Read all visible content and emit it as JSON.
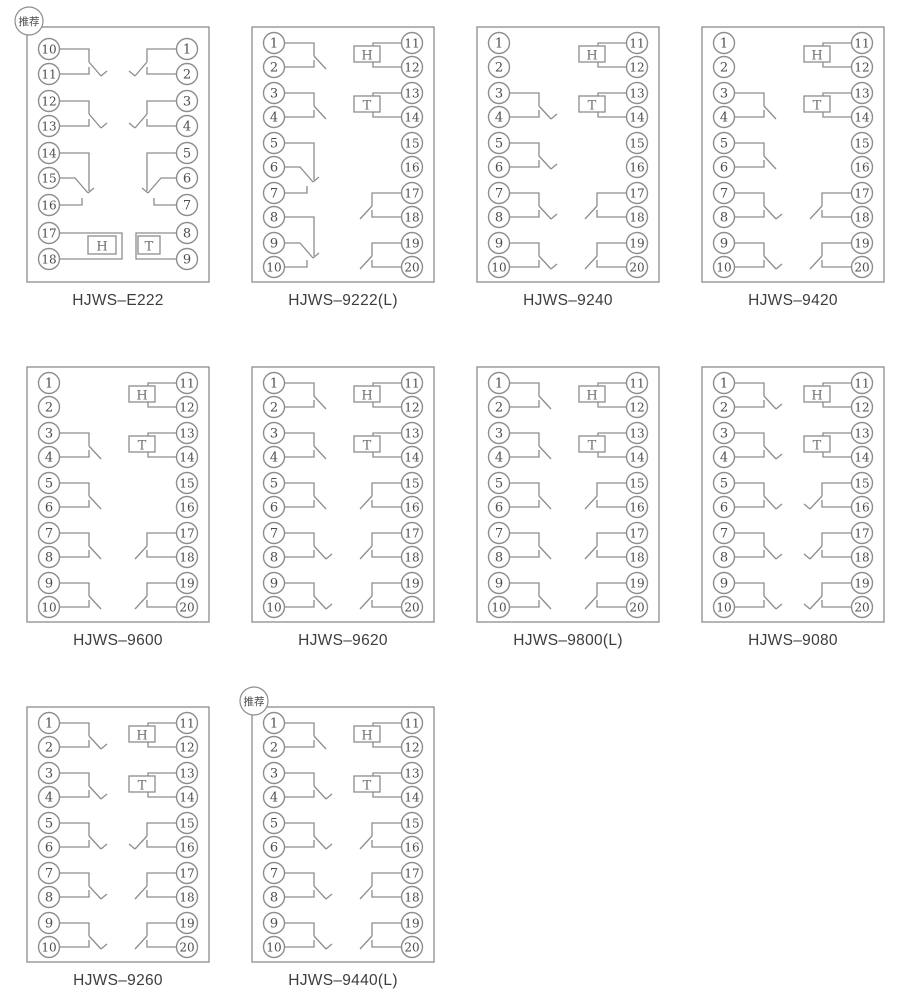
{
  "badge_label": "推荐",
  "colors": {
    "line": "#8d8d8d",
    "terminal_text": "#4c4c4c",
    "label_text": "#3d3d3d",
    "coil_text": "#6e6e6e",
    "background": "#ffffff"
  },
  "diagrams": [
    {
      "id": "hjws-e222",
      "label": "HJWS–E222",
      "badge": true,
      "layout": "nine",
      "left_terminals": [
        "10",
        "11",
        "12",
        "13",
        "14",
        "15",
        "16",
        "17",
        "18"
      ],
      "right_terminals": [
        "1",
        "2",
        "3",
        "4",
        "5",
        "6",
        "7",
        "8",
        "9"
      ],
      "elements": [
        {
          "type": "contact",
          "side": "left",
          "rows": [
            0,
            1
          ],
          "closed": true
        },
        {
          "type": "contact",
          "side": "left",
          "rows": [
            2,
            3
          ],
          "closed": true
        },
        {
          "type": "changeover",
          "side": "left",
          "rows": [
            4,
            5,
            6
          ]
        },
        {
          "type": "coil",
          "side": "left",
          "rows": [
            7,
            8
          ],
          "letter": "H"
        },
        {
          "type": "contact",
          "side": "right",
          "rows": [
            0,
            1
          ],
          "closed": true
        },
        {
          "type": "contact",
          "side": "right",
          "rows": [
            2,
            3
          ],
          "closed": true
        },
        {
          "type": "changeover",
          "side": "right",
          "rows": [
            4,
            5,
            6
          ]
        },
        {
          "type": "coil",
          "side": "right",
          "rows": [
            7,
            8
          ],
          "letter": "T"
        }
      ]
    },
    {
      "id": "hjws-9222l",
      "label": "HJWS–9222(L)",
      "badge": false,
      "layout": "ten",
      "left_terminals": [
        "1",
        "2",
        "3",
        "4",
        "5",
        "6",
        "7",
        "8",
        "9",
        "10"
      ],
      "right_terminals": [
        "11",
        "12",
        "13",
        "14",
        "15",
        "16",
        "17",
        "18",
        "19",
        "20"
      ],
      "elements": [
        {
          "type": "contact",
          "side": "left",
          "rows": [
            0,
            1
          ],
          "closed": false
        },
        {
          "type": "contact",
          "side": "left",
          "rows": [
            2,
            3
          ],
          "closed": false
        },
        {
          "type": "changeover",
          "side": "left",
          "rows": [
            4,
            5,
            6
          ]
        },
        {
          "type": "changeover",
          "side": "left",
          "rows": [
            7,
            8,
            9
          ]
        },
        {
          "type": "coil",
          "side": "right",
          "rows": [
            0,
            1
          ],
          "letter": "H"
        },
        {
          "type": "coil",
          "side": "right",
          "rows": [
            2,
            3
          ],
          "letter": "T"
        },
        {
          "type": "contact",
          "side": "right",
          "rows": [
            6,
            7
          ],
          "closed": false
        },
        {
          "type": "contact",
          "side": "right",
          "rows": [
            8,
            9
          ],
          "closed": false
        }
      ]
    },
    {
      "id": "hjws-9240",
      "label": "HJWS–9240",
      "badge": false,
      "layout": "ten",
      "left_terminals": [
        "1",
        "2",
        "3",
        "4",
        "5",
        "6",
        "7",
        "8",
        "9",
        "10"
      ],
      "right_terminals": [
        "11",
        "12",
        "13",
        "14",
        "15",
        "16",
        "17",
        "18",
        "19",
        "20"
      ],
      "elements": [
        {
          "type": "contact",
          "side": "left",
          "rows": [
            2,
            3
          ],
          "closed": true
        },
        {
          "type": "contact",
          "side": "left",
          "rows": [
            4,
            5
          ],
          "closed": true
        },
        {
          "type": "contact",
          "side": "left",
          "rows": [
            6,
            7
          ],
          "closed": true
        },
        {
          "type": "contact",
          "side": "left",
          "rows": [
            8,
            9
          ],
          "closed": true
        },
        {
          "type": "coil",
          "side": "right",
          "rows": [
            0,
            1
          ],
          "letter": "H"
        },
        {
          "type": "coil",
          "side": "right",
          "rows": [
            2,
            3
          ],
          "letter": "T"
        },
        {
          "type": "contact",
          "side": "right",
          "rows": [
            6,
            7
          ],
          "closed": false
        },
        {
          "type": "contact",
          "side": "right",
          "rows": [
            8,
            9
          ],
          "closed": false
        }
      ]
    },
    {
      "id": "hjws-9420",
      "label": "HJWS–9420",
      "badge": false,
      "layout": "ten",
      "left_terminals": [
        "1",
        "2",
        "3",
        "4",
        "5",
        "6",
        "7",
        "8",
        "9",
        "10"
      ],
      "right_terminals": [
        "11",
        "12",
        "13",
        "14",
        "15",
        "16",
        "17",
        "18",
        "19",
        "20"
      ],
      "elements": [
        {
          "type": "contact",
          "side": "left",
          "rows": [
            2,
            3
          ],
          "closed": false
        },
        {
          "type": "contact",
          "side": "left",
          "rows": [
            4,
            5
          ],
          "closed": false
        },
        {
          "type": "contact",
          "side": "left",
          "rows": [
            6,
            7
          ],
          "closed": true
        },
        {
          "type": "contact",
          "side": "left",
          "rows": [
            8,
            9
          ],
          "closed": true
        },
        {
          "type": "coil",
          "side": "right",
          "rows": [
            0,
            1
          ],
          "letter": "H"
        },
        {
          "type": "coil",
          "side": "right",
          "rows": [
            2,
            3
          ],
          "letter": "T"
        },
        {
          "type": "contact",
          "side": "right",
          "rows": [
            6,
            7
          ],
          "closed": false
        },
        {
          "type": "contact",
          "side": "right",
          "rows": [
            8,
            9
          ],
          "closed": false
        }
      ]
    },
    {
      "id": "hjws-9600",
      "label": "HJWS–9600",
      "badge": false,
      "layout": "ten",
      "left_terminals": [
        "1",
        "2",
        "3",
        "4",
        "5",
        "6",
        "7",
        "8",
        "9",
        "10"
      ],
      "right_terminals": [
        "11",
        "12",
        "13",
        "14",
        "15",
        "16",
        "17",
        "18",
        "19",
        "20"
      ],
      "elements": [
        {
          "type": "contact",
          "side": "left",
          "rows": [
            2,
            3
          ],
          "closed": false
        },
        {
          "type": "contact",
          "side": "left",
          "rows": [
            4,
            5
          ],
          "closed": false
        },
        {
          "type": "contact",
          "side": "left",
          "rows": [
            6,
            7
          ],
          "closed": false
        },
        {
          "type": "contact",
          "side": "left",
          "rows": [
            8,
            9
          ],
          "closed": false
        },
        {
          "type": "coil",
          "side": "right",
          "rows": [
            0,
            1
          ],
          "letter": "H"
        },
        {
          "type": "coil",
          "side": "right",
          "rows": [
            2,
            3
          ],
          "letter": "T"
        },
        {
          "type": "contact",
          "side": "right",
          "rows": [
            6,
            7
          ],
          "closed": false
        },
        {
          "type": "contact",
          "side": "right",
          "rows": [
            8,
            9
          ],
          "closed": false
        }
      ]
    },
    {
      "id": "hjws-9620",
      "label": "HJWS–9620",
      "badge": false,
      "layout": "ten",
      "left_terminals": [
        "1",
        "2",
        "3",
        "4",
        "5",
        "6",
        "7",
        "8",
        "9",
        "10"
      ],
      "right_terminals": [
        "11",
        "12",
        "13",
        "14",
        "15",
        "16",
        "17",
        "18",
        "19",
        "20"
      ],
      "elements": [
        {
          "type": "contact",
          "side": "left",
          "rows": [
            0,
            1
          ],
          "closed": false
        },
        {
          "type": "contact",
          "side": "left",
          "rows": [
            2,
            3
          ],
          "closed": false
        },
        {
          "type": "contact",
          "side": "left",
          "rows": [
            4,
            5
          ],
          "closed": false
        },
        {
          "type": "contact",
          "side": "left",
          "rows": [
            6,
            7
          ],
          "closed": true
        },
        {
          "type": "contact",
          "side": "left",
          "rows": [
            8,
            9
          ],
          "closed": true
        },
        {
          "type": "coil",
          "side": "right",
          "rows": [
            0,
            1
          ],
          "letter": "H"
        },
        {
          "type": "coil",
          "side": "right",
          "rows": [
            2,
            3
          ],
          "letter": "T"
        },
        {
          "type": "contact",
          "side": "right",
          "rows": [
            4,
            5
          ],
          "closed": false
        },
        {
          "type": "contact",
          "side": "right",
          "rows": [
            6,
            7
          ],
          "closed": false
        },
        {
          "type": "contact",
          "side": "right",
          "rows": [
            8,
            9
          ],
          "closed": false
        }
      ]
    },
    {
      "id": "hjws-9800l",
      "label": "HJWS–9800(L)",
      "badge": false,
      "layout": "ten",
      "left_terminals": [
        "1",
        "2",
        "3",
        "4",
        "5",
        "6",
        "7",
        "8",
        "9",
        "10"
      ],
      "right_terminals": [
        "11",
        "12",
        "13",
        "14",
        "15",
        "16",
        "17",
        "18",
        "19",
        "20"
      ],
      "elements": [
        {
          "type": "contact",
          "side": "left",
          "rows": [
            0,
            1
          ],
          "closed": false
        },
        {
          "type": "contact",
          "side": "left",
          "rows": [
            2,
            3
          ],
          "closed": false
        },
        {
          "type": "contact",
          "side": "left",
          "rows": [
            4,
            5
          ],
          "closed": false
        },
        {
          "type": "contact",
          "side": "left",
          "rows": [
            6,
            7
          ],
          "closed": false
        },
        {
          "type": "contact",
          "side": "left",
          "rows": [
            8,
            9
          ],
          "closed": false
        },
        {
          "type": "coil",
          "side": "right",
          "rows": [
            0,
            1
          ],
          "letter": "H"
        },
        {
          "type": "coil",
          "side": "right",
          "rows": [
            2,
            3
          ],
          "letter": "T"
        },
        {
          "type": "contact",
          "side": "right",
          "rows": [
            4,
            5
          ],
          "closed": false
        },
        {
          "type": "contact",
          "side": "right",
          "rows": [
            6,
            7
          ],
          "closed": false
        },
        {
          "type": "contact",
          "side": "right",
          "rows": [
            8,
            9
          ],
          "closed": false
        }
      ]
    },
    {
      "id": "hjws-9080",
      "label": "HJWS–9080",
      "badge": false,
      "layout": "ten",
      "left_terminals": [
        "1",
        "2",
        "3",
        "4",
        "5",
        "6",
        "7",
        "8",
        "9",
        "10"
      ],
      "right_terminals": [
        "11",
        "12",
        "13",
        "14",
        "15",
        "16",
        "17",
        "18",
        "19",
        "20"
      ],
      "elements": [
        {
          "type": "contact",
          "side": "left",
          "rows": [
            0,
            1
          ],
          "closed": true
        },
        {
          "type": "contact",
          "side": "left",
          "rows": [
            2,
            3
          ],
          "closed": true
        },
        {
          "type": "contact",
          "side": "left",
          "rows": [
            4,
            5
          ],
          "closed": true
        },
        {
          "type": "contact",
          "side": "left",
          "rows": [
            6,
            7
          ],
          "closed": true
        },
        {
          "type": "contact",
          "side": "left",
          "rows": [
            8,
            9
          ],
          "closed": true
        },
        {
          "type": "coil",
          "side": "right",
          "rows": [
            0,
            1
          ],
          "letter": "H"
        },
        {
          "type": "coil",
          "side": "right",
          "rows": [
            2,
            3
          ],
          "letter": "T"
        },
        {
          "type": "contact",
          "side": "right",
          "rows": [
            4,
            5
          ],
          "closed": true
        },
        {
          "type": "contact",
          "side": "right",
          "rows": [
            6,
            7
          ],
          "closed": true
        },
        {
          "type": "contact",
          "side": "right",
          "rows": [
            8,
            9
          ],
          "closed": true
        }
      ]
    },
    {
      "id": "hjws-9260",
      "label": "HJWS–9260",
      "badge": false,
      "layout": "ten",
      "left_terminals": [
        "1",
        "2",
        "3",
        "4",
        "5",
        "6",
        "7",
        "8",
        "9",
        "10"
      ],
      "right_terminals": [
        "11",
        "12",
        "13",
        "14",
        "15",
        "16",
        "17",
        "18",
        "19",
        "20"
      ],
      "elements": [
        {
          "type": "contact",
          "side": "left",
          "rows": [
            0,
            1
          ],
          "closed": true
        },
        {
          "type": "contact",
          "side": "left",
          "rows": [
            2,
            3
          ],
          "closed": true
        },
        {
          "type": "contact",
          "side": "left",
          "rows": [
            4,
            5
          ],
          "closed": true
        },
        {
          "type": "contact",
          "side": "left",
          "rows": [
            6,
            7
          ],
          "closed": true
        },
        {
          "type": "contact",
          "side": "left",
          "rows": [
            8,
            9
          ],
          "closed": true
        },
        {
          "type": "coil",
          "side": "right",
          "rows": [
            0,
            1
          ],
          "letter": "H"
        },
        {
          "type": "coil",
          "side": "right",
          "rows": [
            2,
            3
          ],
          "letter": "T"
        },
        {
          "type": "contact",
          "side": "right",
          "rows": [
            4,
            5
          ],
          "closed": true
        },
        {
          "type": "contact",
          "side": "right",
          "rows": [
            6,
            7
          ],
          "closed": false
        },
        {
          "type": "contact",
          "side": "right",
          "rows": [
            8,
            9
          ],
          "closed": false
        }
      ]
    },
    {
      "id": "hjws-9440l",
      "label": "HJWS–9440(L)",
      "badge": true,
      "layout": "ten",
      "left_terminals": [
        "1",
        "2",
        "3",
        "4",
        "5",
        "6",
        "7",
        "8",
        "9",
        "10"
      ],
      "right_terminals": [
        "11",
        "12",
        "13",
        "14",
        "15",
        "16",
        "17",
        "18",
        "19",
        "20"
      ],
      "elements": [
        {
          "type": "contact",
          "side": "left",
          "rows": [
            0,
            1
          ],
          "closed": false
        },
        {
          "type": "contact",
          "side": "left",
          "rows": [
            2,
            3
          ],
          "closed": true
        },
        {
          "type": "contact",
          "side": "left",
          "rows": [
            4,
            5
          ],
          "closed": true
        },
        {
          "type": "contact",
          "side": "left",
          "rows": [
            6,
            7
          ],
          "closed": true
        },
        {
          "type": "contact",
          "side": "left",
          "rows": [
            8,
            9
          ],
          "closed": true
        },
        {
          "type": "coil",
          "side": "right",
          "rows": [
            0,
            1
          ],
          "letter": "H"
        },
        {
          "type": "coil",
          "side": "right",
          "rows": [
            2,
            3
          ],
          "letter": "T"
        },
        {
          "type": "contact",
          "side": "right",
          "rows": [
            4,
            5
          ],
          "closed": false
        },
        {
          "type": "contact",
          "side": "right",
          "rows": [
            6,
            7
          ],
          "closed": false
        },
        {
          "type": "contact",
          "side": "right",
          "rows": [
            8,
            9
          ],
          "closed": false
        }
      ]
    }
  ]
}
